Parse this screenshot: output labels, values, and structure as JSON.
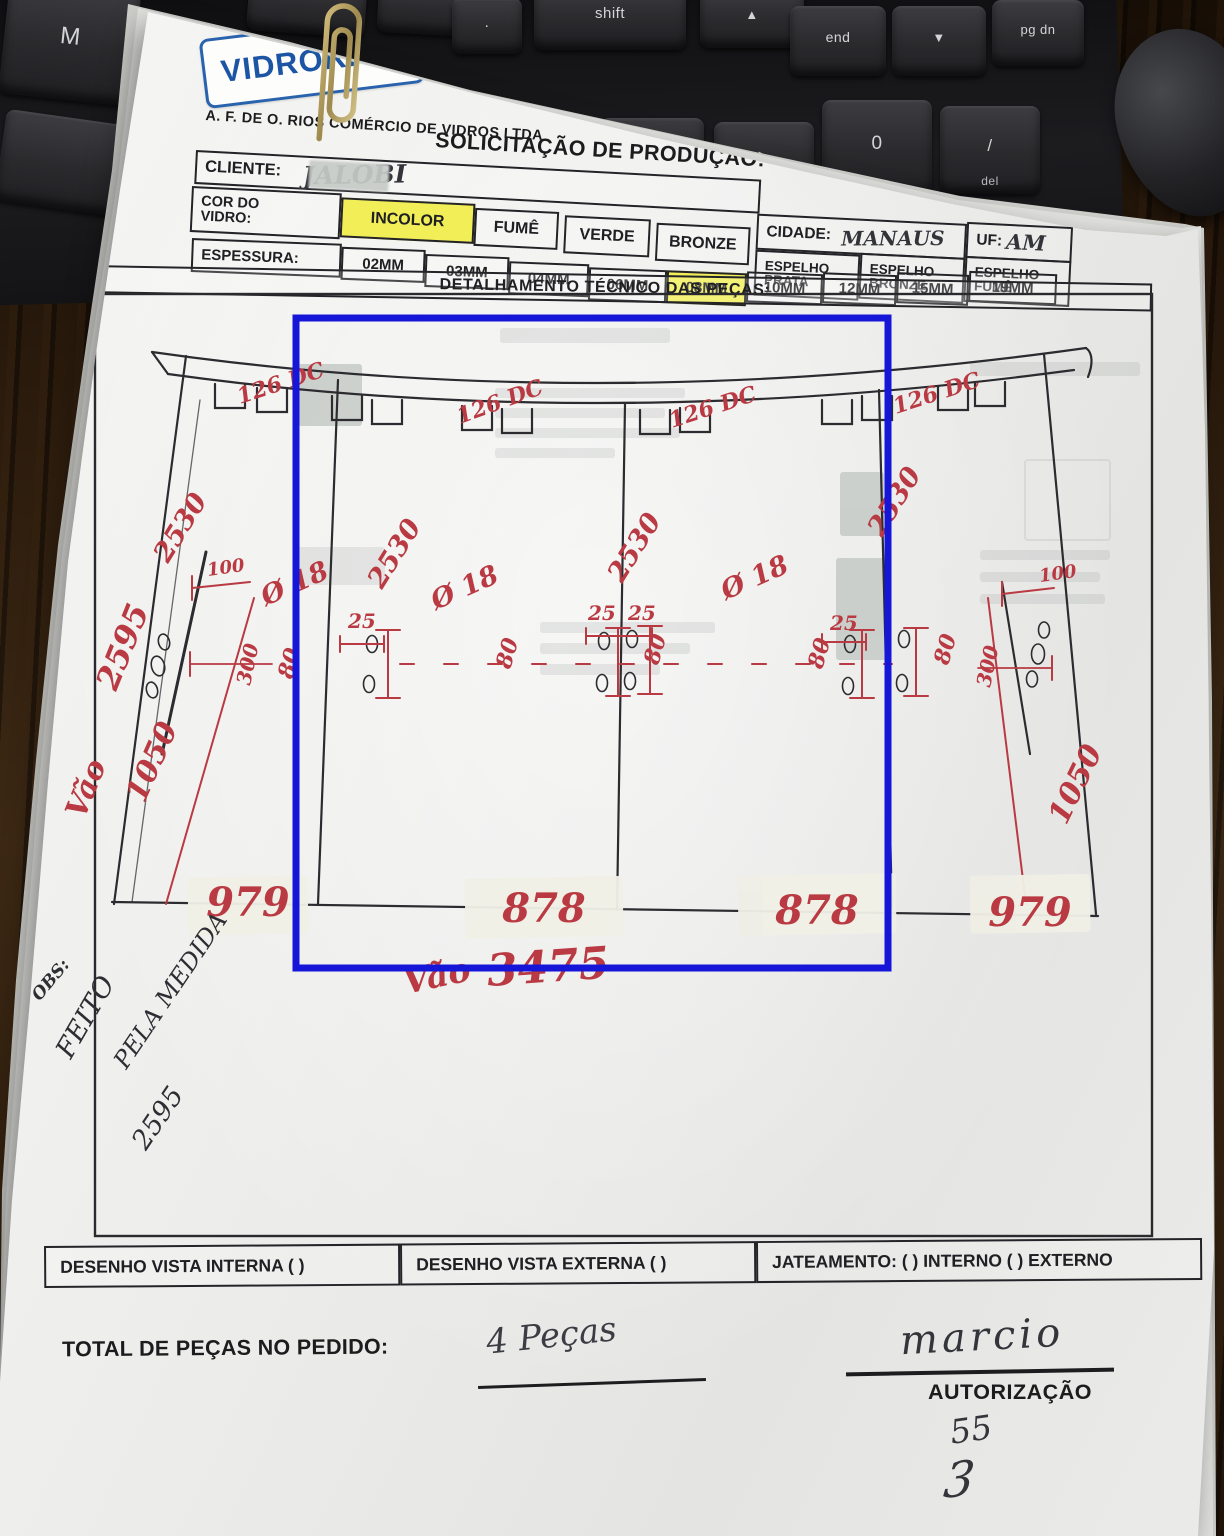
{
  "scene": {
    "keys": [
      {
        "label": "M",
        "sub": ""
      },
      {
        "label": ".",
        "sub": ""
      },
      {
        "label": "shift",
        "sub": ""
      },
      {
        "label": "▲",
        "sub": ""
      },
      {
        "label": "end",
        "sub": ""
      },
      {
        "label": "▼",
        "sub": ""
      },
      {
        "label": "pg dn",
        "sub": ""
      },
      {
        "label": "▼",
        "sub": ""
      },
      {
        "label": "▶",
        "sub": ""
      },
      {
        "label": "0",
        "sub": "ins"
      },
      {
        "label": "/",
        "sub": "del"
      }
    ]
  },
  "header": {
    "logo": "VIDRORIOS",
    "company": "A. F. DE O. RIOS COMÉRCIO DE VIDROS LTDA",
    "title": "SOLICITAÇÃO DE PRODUÇÃO:",
    "date_label": "DATA:",
    "date_value": "1º/07/25",
    "client_label": "CLIENTE:",
    "client_value": "JALOBI",
    "color_label": "COR DO VIDRO:",
    "colors": [
      {
        "label": "INCOLOR"
      },
      {
        "label": "FUMÊ"
      },
      {
        "label": "VERDE"
      },
      {
        "label": "BRONZE"
      }
    ],
    "mirrors": [
      "ESPELHO PRATA",
      "ESPELHO BRONZE",
      "ESPELHO FUMÊ"
    ],
    "cidade_label": "CIDADE:",
    "cidade_value": "MANAUS",
    "uf_label": "UF:",
    "uf_value": "AM",
    "thickness_label": "ESPESSURA:",
    "thicknesses": [
      {
        "label": "02MM"
      },
      {
        "label": "03MM"
      },
      {
        "label": "04MM"
      },
      {
        "label": "06MM"
      },
      {
        "label": "08MM"
      },
      {
        "label": "10MM"
      },
      {
        "label": "12MM"
      },
      {
        "label": "15MM"
      },
      {
        "label": "19MM"
      }
    ]
  },
  "drawing": {
    "heading": "DETALHAMENTO TÉCNICO DAS PEÇAS:",
    "vao_label": "Vão",
    "left_total_height": "2595",
    "panel_height": "2530",
    "hole_offset_126": "126 DC",
    "hole_dia": "Ø 18",
    "dim_25": "25",
    "dim_80": "80",
    "dim_300": "300",
    "dim_100": "100",
    "dim_1050": "1050",
    "widths": [
      "979",
      "878",
      "878",
      "979"
    ],
    "total_span_label": "Vão",
    "total_span": "3475"
  },
  "notes": {
    "obs": "OBS:",
    "line1": "FEITO",
    "line2": "PELA MEDIDA",
    "line3": "2595"
  },
  "footer": {
    "vista_interna": "DESENHO VISTA INTERNA ( )",
    "vista_externa": "DESENHO VISTA EXTERNA ( )",
    "jateamento": "JATEAMENTO: ( ) INTERNO ( ) EXTERNO",
    "total_label": "TOTAL DE PEÇAS NO PEDIDO:",
    "total_value": "4 Peças",
    "signature": "marcio",
    "auth_label": "AUTORIZAÇÃO",
    "auth_num": "55",
    "auth_scribble": "3"
  },
  "colors": {
    "annotation_blue": "#1516d8",
    "ink_red": "#b93a42",
    "highlight_yellow": "#f1ee58",
    "logo_blue": "#1d55a5"
  }
}
